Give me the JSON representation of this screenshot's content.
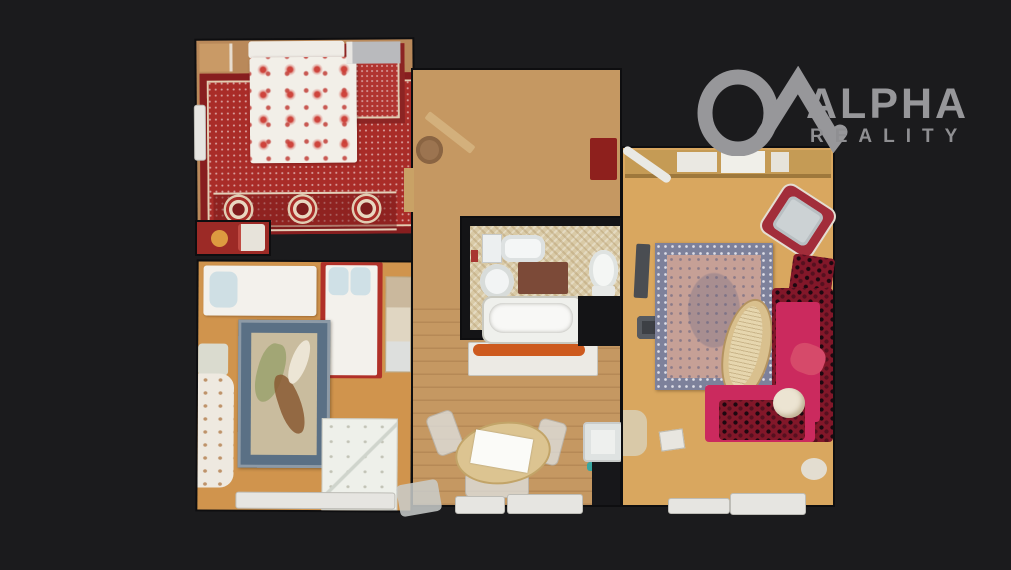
{
  "page": {
    "background_color": "#1b1b1d",
    "kind": "real-estate top-down 3D floor plan scan"
  },
  "logo": {
    "brand": "ALPHA",
    "subtitle": "REALITY",
    "color": "#97979a",
    "icon": "alpha-roof-icon"
  },
  "floor_plan": {
    "rooms": [
      {
        "name": "Master bedroom",
        "position": "top-left",
        "floor": "wood",
        "features": [
          "red oriental carpet with medallions",
          "double bed with white duvet and red floral pattern",
          "pillows",
          "left wall radiator",
          "nightstand",
          "bench with orange ball"
        ]
      },
      {
        "name": "Second bedroom",
        "position": "bottom-left",
        "floor": "orange wood",
        "features": [
          "horizontal single bed with blue pillow",
          "vertical single bed with red frame and two blue pillows",
          "blue-bordered area rug with abstract pattern",
          "curtain",
          "frosted door panel",
          "radiator",
          "shelf"
        ]
      },
      {
        "name": "Hallway",
        "position": "center",
        "floor": "light wood planks",
        "features": [
          "dark red door mat",
          "round pouf",
          "leaning board",
          "shelf with orange items",
          "oval dining table with paper",
          "chairs",
          "radiators",
          "washing machine",
          "teal item"
        ]
      },
      {
        "name": "Bathroom",
        "position": "center",
        "floor": "beige mosaic tile",
        "features": [
          "toilet with cistern",
          "round sink",
          "brown bath mat",
          "second toilet",
          "bathtub"
        ]
      },
      {
        "name": "Living room",
        "position": "right",
        "floor": "light wood",
        "features": [
          "top wall cabinets",
          "ironing board",
          "TV",
          "console",
          "blue-bordered persian rug",
          "oval wicker coffee table",
          "red armchair with grey cushion",
          "leopard ottoman",
          "magenta corner sofa with leopard cushions",
          "white round pillow",
          "radiators"
        ]
      }
    ],
    "colors": {
      "carpet_red": "#a92c28",
      "hall_wood": "#c59862",
      "bedroom2_wood": "#d0944d",
      "living_wood": "#d9a75f",
      "bath_tile": "#d9caa6",
      "sofa_magenta": "#cb2a5e",
      "leopard_dark_red": "#821729",
      "rug_blue_border": "#5a7085",
      "door_mat_red": "#8e201d"
    }
  }
}
